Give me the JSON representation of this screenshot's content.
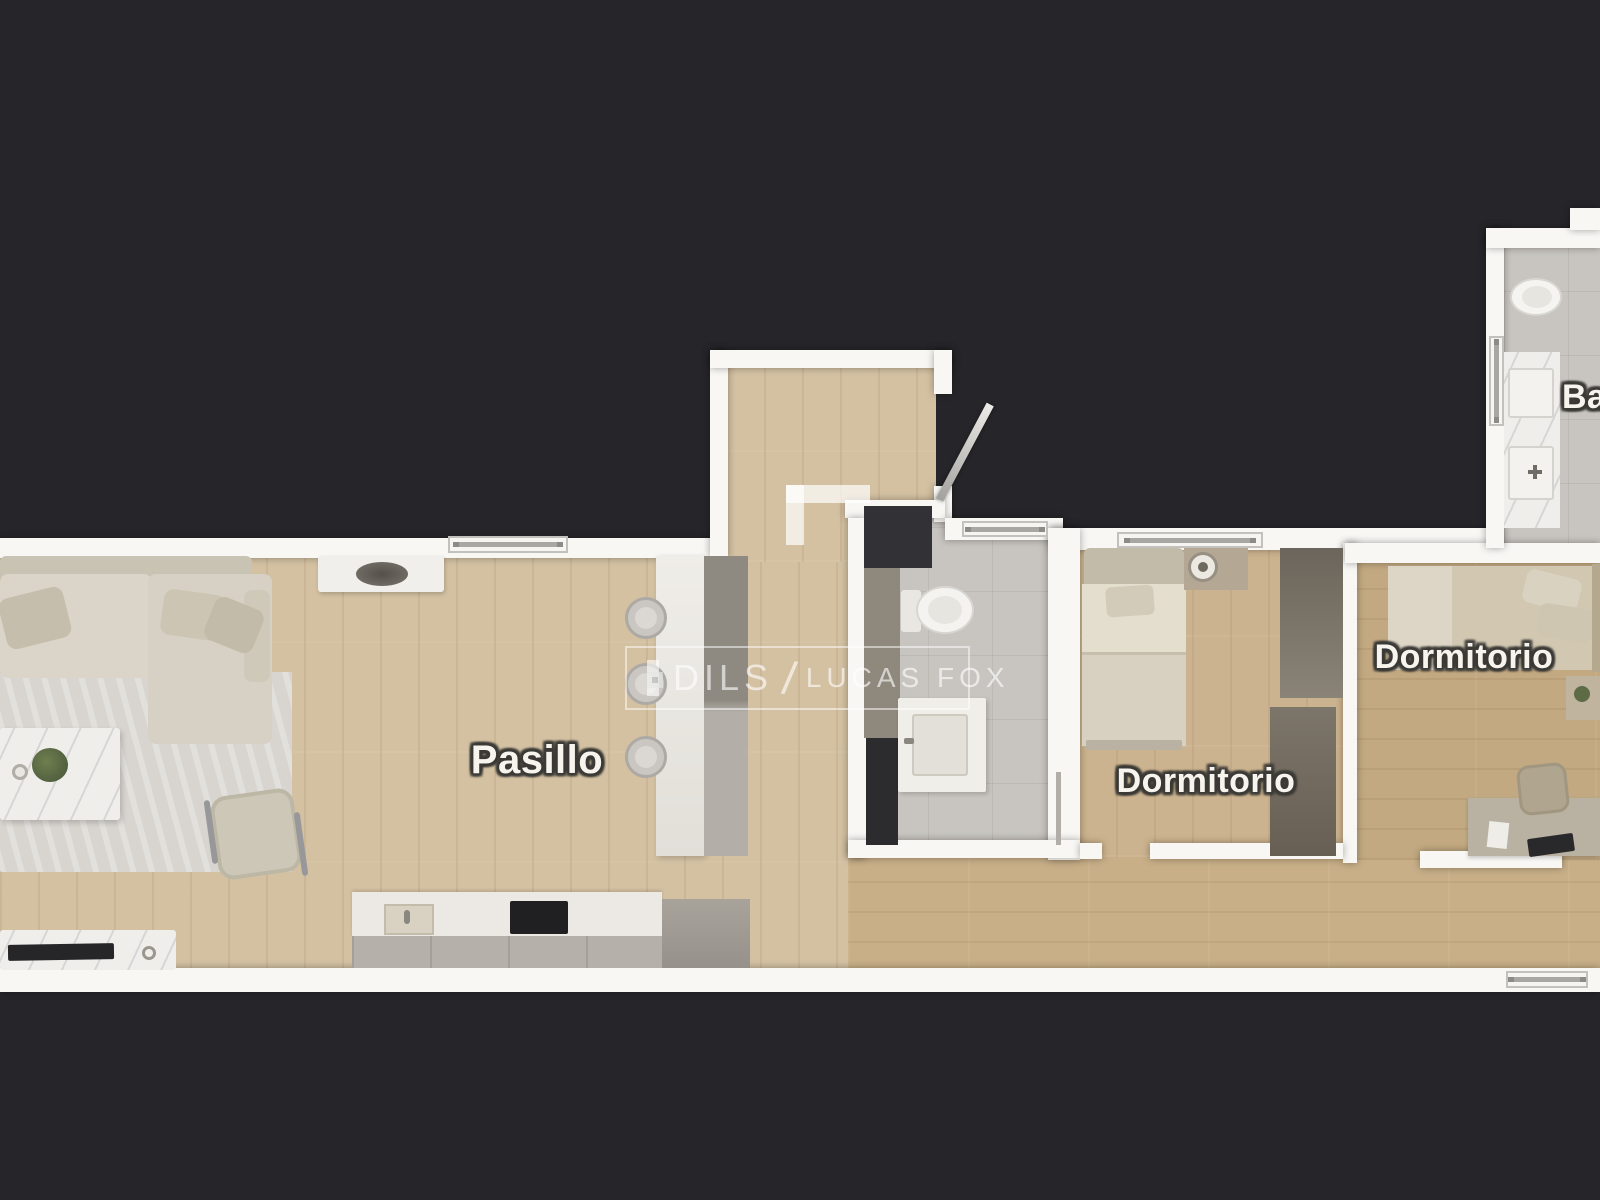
{
  "scene": {
    "kind": "3d-floor-plan-top-view",
    "brand_watermark_present": true
  },
  "rooms": {
    "hallway": {
      "label": "Pasillo"
    },
    "bedroom_middle": {
      "label": "Dormitorio"
    },
    "bedroom_right": {
      "label": "Dormitorio"
    },
    "bathroom_top_right": {
      "label_partial": "Ba"
    }
  },
  "watermark": {
    "logo": "dils-square-logo",
    "brand_primary": "DILS",
    "separator": "/",
    "brand_secondary": "LUCAS FOX"
  },
  "palette": {
    "background": "#26262a",
    "wall_white": "#f8f7f4",
    "wood_floor": "#d4c1a2",
    "wood_floor_dark": "#c8af88",
    "tile_gray": "#c8c5c0",
    "rug_gray": "#d8d5d0",
    "cooktop_black": "#202022",
    "accent_dark_wall": "#323236",
    "furniture_beige": "#d8d3c7",
    "watermark_white": "rgba(255,255,255,0.62)"
  }
}
